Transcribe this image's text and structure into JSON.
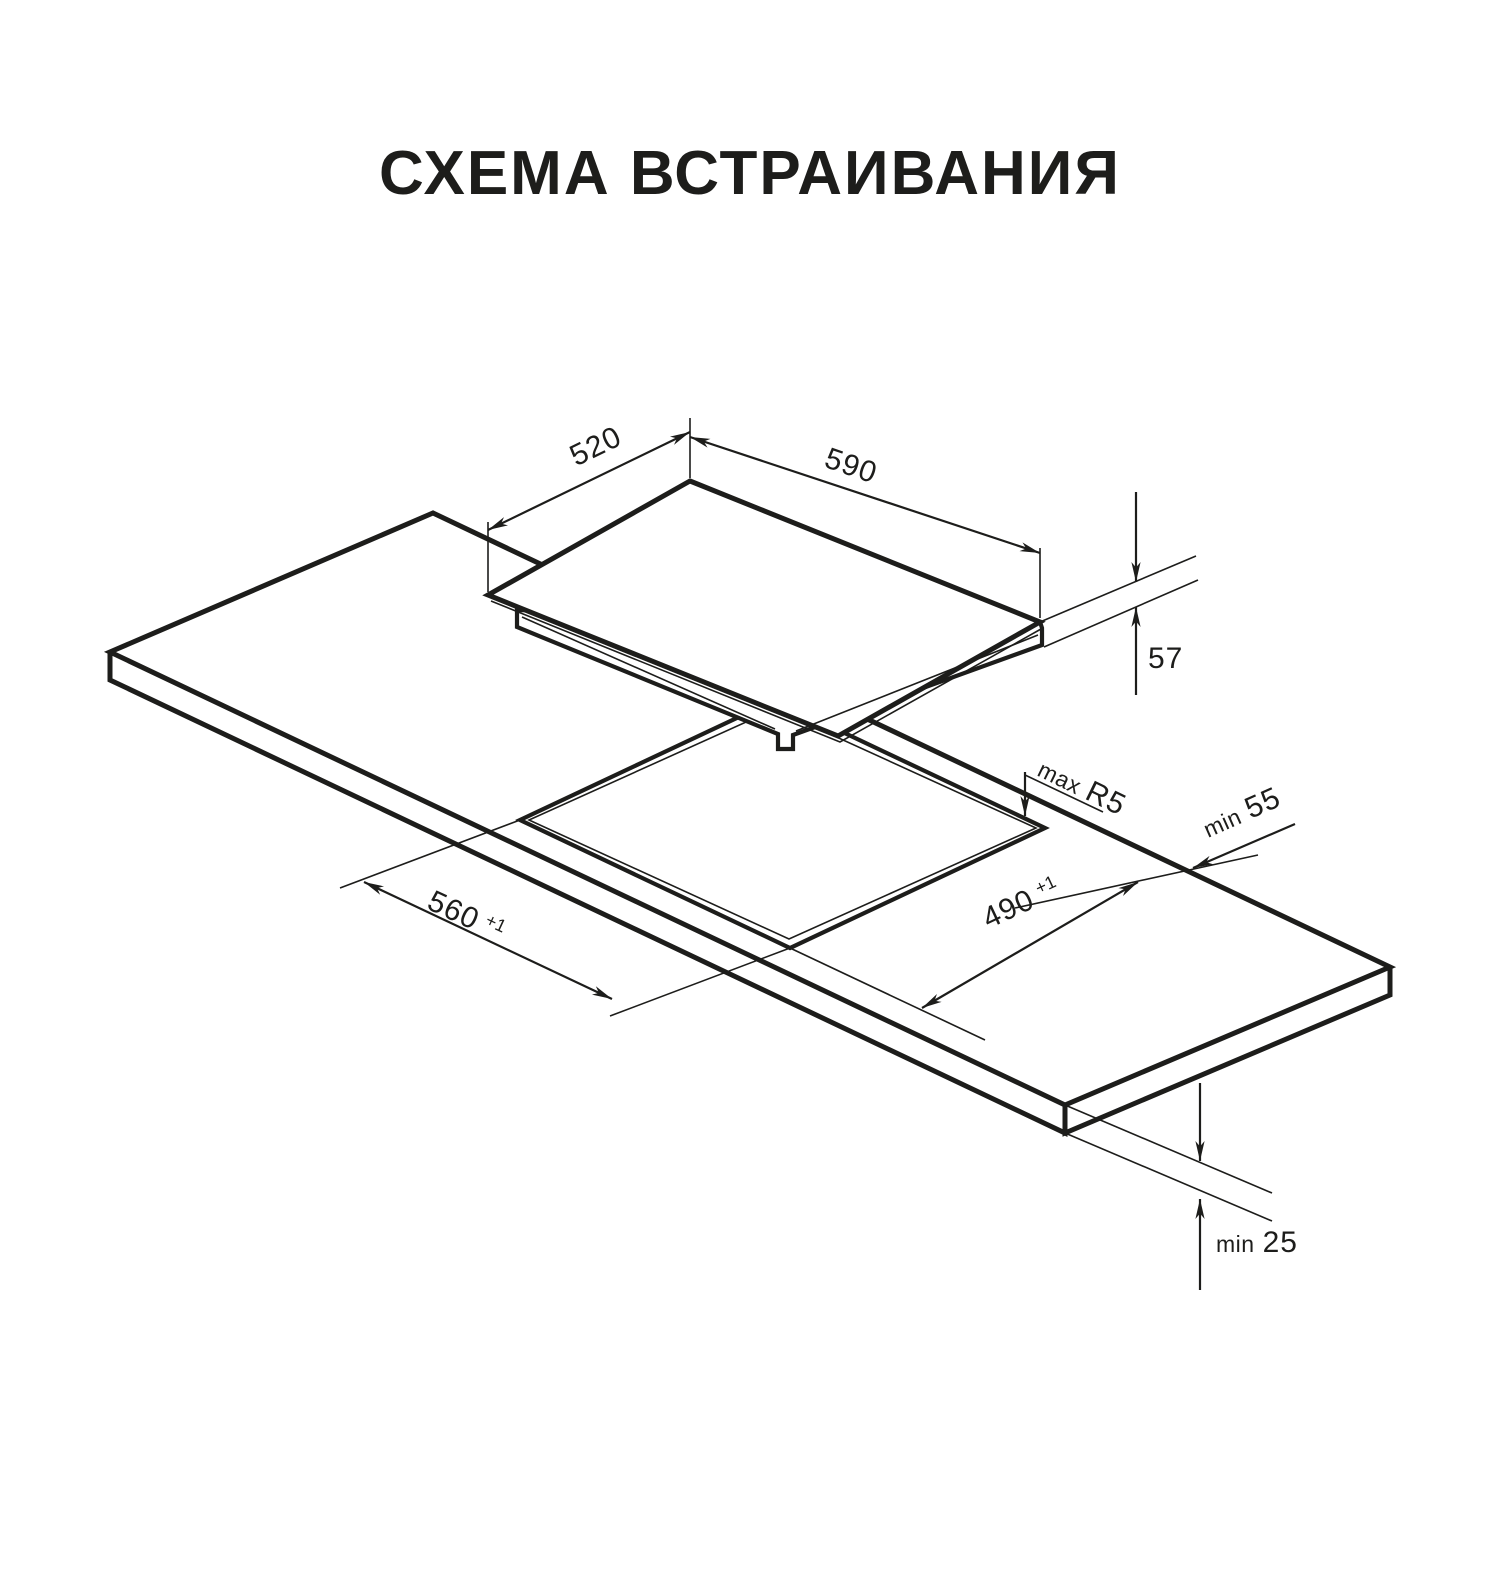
{
  "title": "СХЕМА ВСТРАИВАНИЯ",
  "diagram": {
    "type": "isometric installation drawing of built-in cooktop into worktop cutout",
    "ink_color": "#1d1d1b",
    "background_color": "#ffffff",
    "dimensions": {
      "hob_depth": {
        "value": "520",
        "unit": "mm"
      },
      "hob_width": {
        "value": "590",
        "unit": "mm"
      },
      "hob_height": {
        "value": "57",
        "unit": "mm"
      },
      "cutout_corner_radius): comment": "",
      "corner_radius": {
        "qualifier": "max",
        "value": "R5"
      },
      "rear_clearance": {
        "qualifier": "min",
        "value": "55"
      },
      "cutout_width": {
        "value": "560",
        "tolerance": "+1"
      },
      "cutout_depth": {
        "value": "490",
        "tolerance": "+1"
      },
      "worktop_thickness": {
        "qualifier": "min",
        "value": "25"
      }
    }
  }
}
